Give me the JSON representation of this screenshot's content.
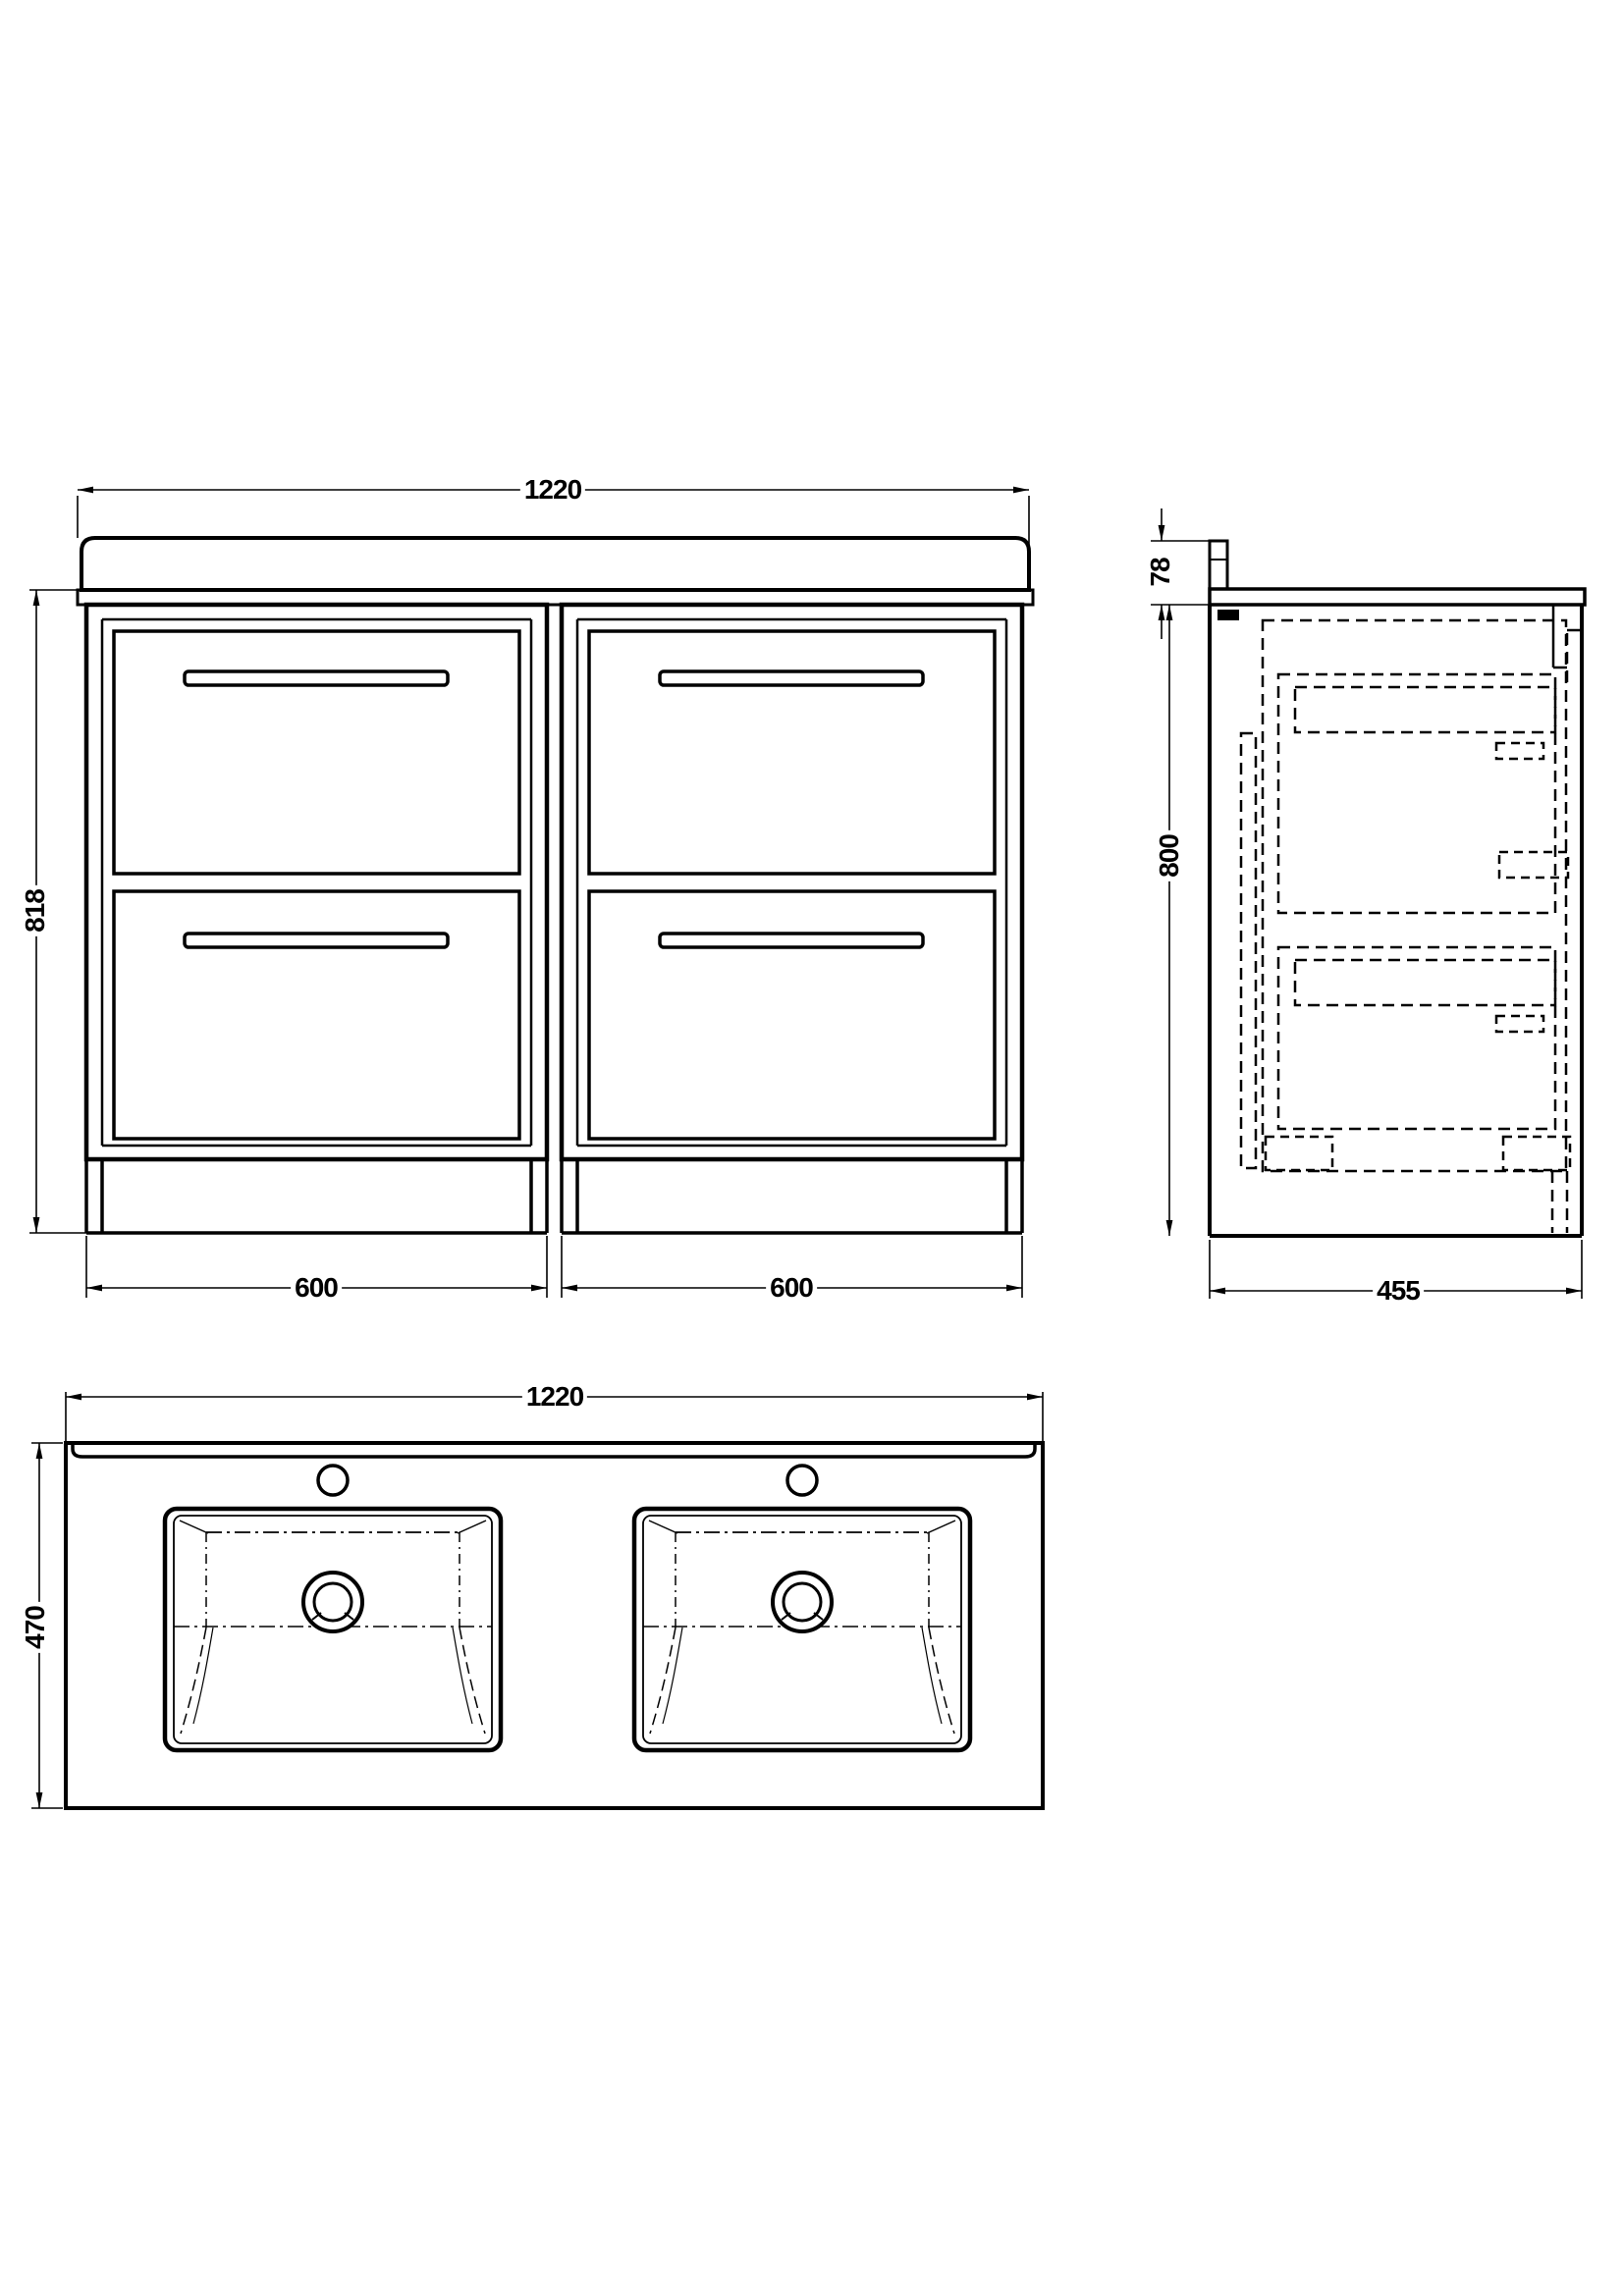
{
  "drawing": {
    "type": "technical-orthographic-drawing",
    "subject": "double basin floor-standing vanity unit with four drawers",
    "line_color": "#000000",
    "background_color": "#ffffff",
    "front_view": {
      "overall_width": "1220",
      "overall_height": "818",
      "left_module_width": "600",
      "right_module_width": "600"
    },
    "side_view": {
      "upstand_height": "78",
      "cabinet_height": "800",
      "depth": "455"
    },
    "plan_view": {
      "overall_width": "1220",
      "overall_depth": "470"
    }
  }
}
